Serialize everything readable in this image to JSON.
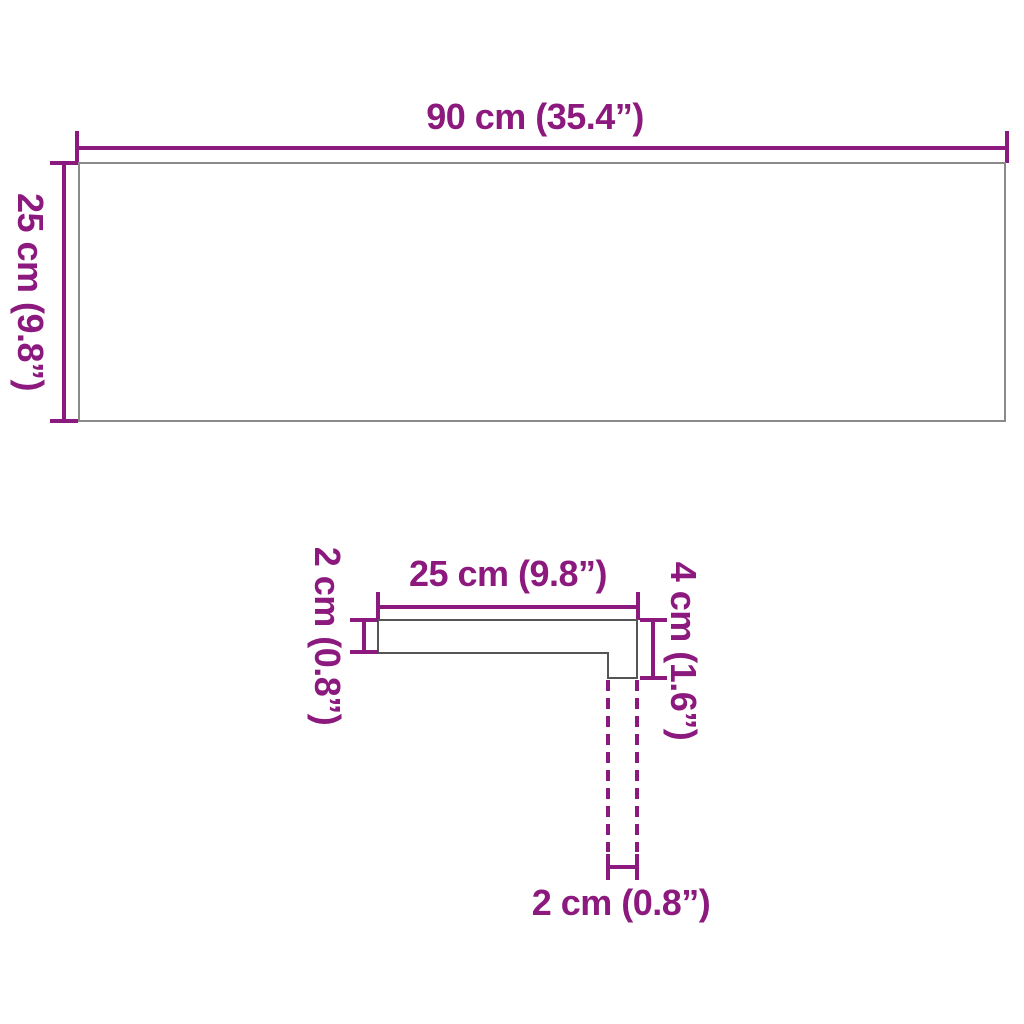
{
  "colors": {
    "dimension": "#8C197D",
    "panel_outline": "#8A8A8A",
    "profile_outline": "#555555",
    "background": "#FFFFFF"
  },
  "top_view": {
    "width_label": "90 cm (35.4”)",
    "height_label": "25 cm (9.8”)"
  },
  "profile_view": {
    "width_label": "25 cm (9.8”)",
    "thickness_label": "2 cm (0.8”)",
    "nose_height_label": "4 cm (1.6”)",
    "nose_depth_label": "2 cm (0.8”)"
  }
}
